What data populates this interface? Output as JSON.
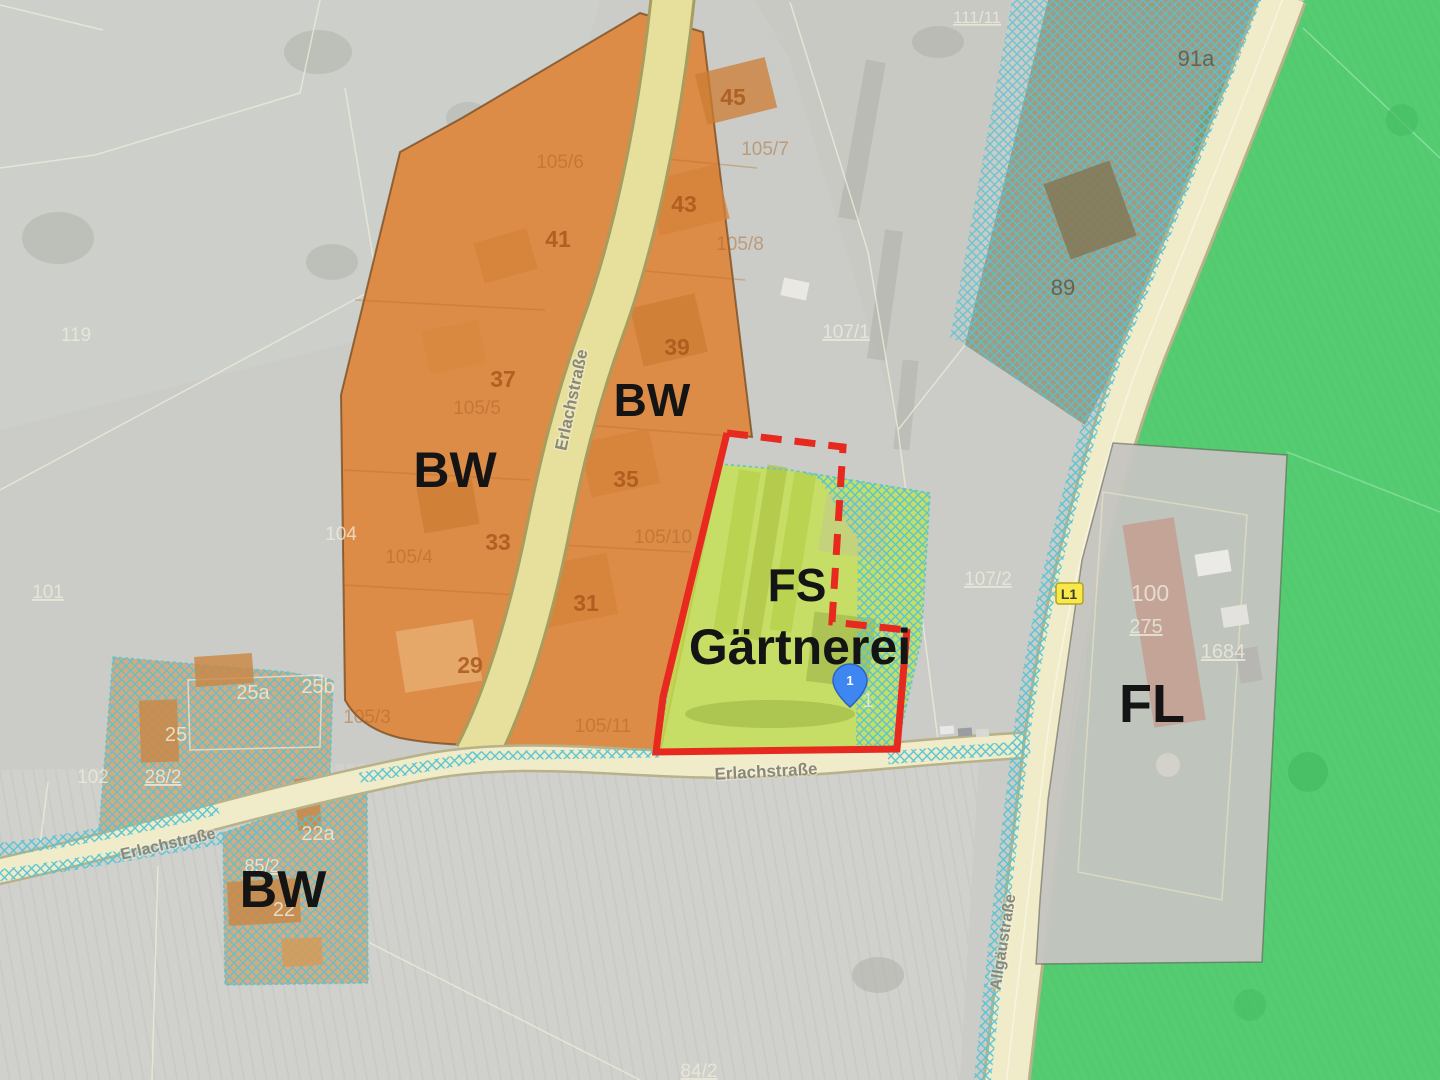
{
  "colors": {
    "aerial_base": "#cbccc7",
    "zone_residential_orange": "#dd8c48",
    "zone_fs_green": "#c6df55",
    "field_green": "#55cc72",
    "hatch_blue": "#55c3d3",
    "hatched_brown": "#998c6a",
    "hatched_orange_block": "#db9a60",
    "road_fill": "#f0ecca",
    "road_minor_fill": "#e7e09c",
    "boundary_red": "#e8291f",
    "parcel_line": "#efecda",
    "fl_gray": "#c6c5c0",
    "pin_blue": "#3e86f1"
  },
  "zone_labels": {
    "bw_left": "BW",
    "bw_top": "BW",
    "bw_bottom": "BW",
    "fs": "FS",
    "gaertnerei": "Gärtnerei",
    "fl": "FL"
  },
  "street_labels": {
    "erlachstrasse_vertical": "Erlachstraße",
    "erlachstrasse_center": "Erlachstraße",
    "erlachstrasse_west": "Erlachstraße",
    "allgaeustrasse": "Allgäustraße",
    "road_shield_l1": "L1"
  },
  "parcel_labels": {
    "orange_main": [
      "45",
      "43",
      "41",
      "39",
      "37",
      "35",
      "33",
      "31",
      "29"
    ],
    "orange_faint": [
      "105/6",
      "105/7",
      "105/8",
      "105/5",
      "105/4",
      "105/10",
      "105/3",
      "105/11"
    ],
    "gray": [
      "119",
      "104",
      "101",
      "102",
      "107/1",
      "107/2",
      "111/11",
      "84/2"
    ],
    "hatched_cream": [
      "25a",
      "25b",
      "25",
      "28/2",
      "22a",
      "22",
      "85/2"
    ],
    "hatched_dark": [
      "91a",
      "89"
    ],
    "fl_area": [
      "100",
      "275",
      "1684"
    ]
  },
  "marker": {
    "pin_number": "1",
    "ghost_house_number": "1"
  }
}
